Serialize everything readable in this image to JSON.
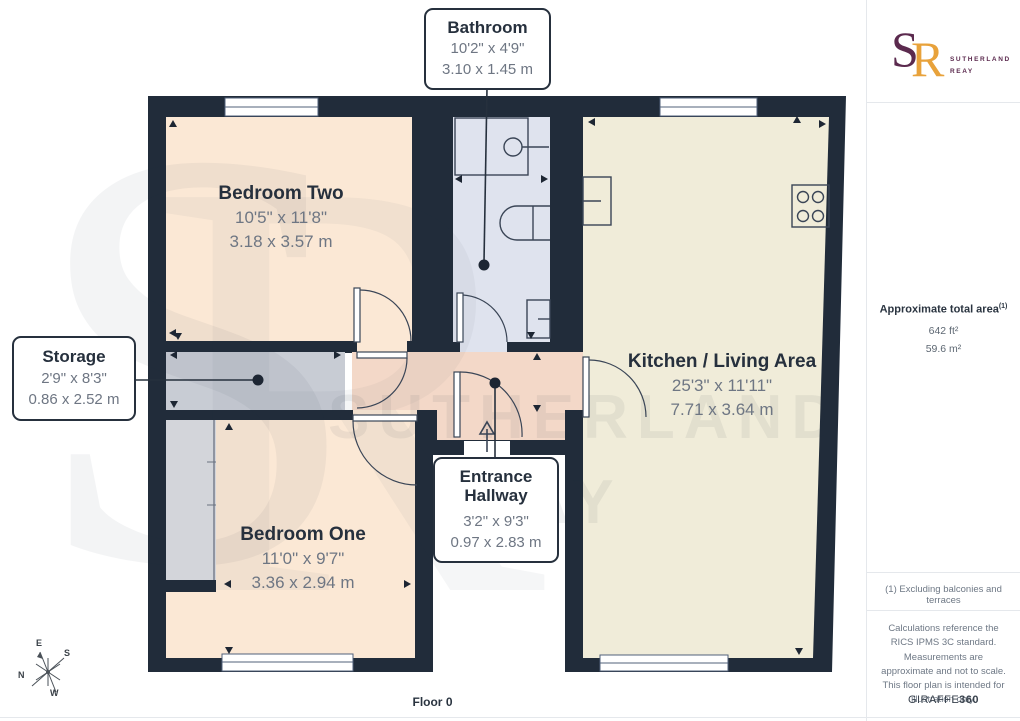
{
  "floorplan": {
    "floor_label": "Floor 0",
    "rooms": {
      "bathroom": {
        "name": "Bathroom",
        "imperial": "10'2\" x 4'9\"",
        "metric": "3.10 x 1.45 m"
      },
      "bedroom_two": {
        "name": "Bedroom Two",
        "imperial": "10'5\" x 11'8\"",
        "metric": "3.18 x 3.57 m"
      },
      "storage": {
        "name": "Storage",
        "imperial": "2'9\" x 8'3\"",
        "metric": "0.86 x 2.52 m"
      },
      "bedroom_one": {
        "name": "Bedroom One",
        "imperial": "11'0\" x 9'7\"",
        "metric": "3.36 x 2.94 m"
      },
      "kitchen_living": {
        "name": "Kitchen / Living Area",
        "imperial": "25'3\" x 11'11\"",
        "metric": "7.71 x 3.64 m"
      },
      "entrance_hallway": {
        "name_line1": "Entrance",
        "name_line2": "Hallway",
        "imperial": "3'2\" x 9'3\"",
        "metric": "0.97 x 2.83 m"
      }
    },
    "compass": {
      "n": "N",
      "e": "E",
      "s": "S",
      "w": "W"
    }
  },
  "watermark": {
    "monogram_s": "S",
    "monogram_r": "R",
    "line1": "SUTHERLAND",
    "line2": "REAY"
  },
  "sidebar": {
    "logo": {
      "monogram_s": "S",
      "monogram_r": "R",
      "name_line1": "SUTHERLAND",
      "name_line2": "REAY"
    },
    "area": {
      "title": "Approximate total area",
      "note_ref": "(1)",
      "imperial": "642 ft²",
      "metric": "59.6 m²"
    },
    "footnote": "(1) Excluding balconies and terraces",
    "disclaimer": "Calculations reference the RICS IPMS 3C standard. Measurements are approximate and not to scale. This floor plan is intended for illustration only.",
    "brand_name": "GIRAFFE",
    "brand_suffix": "360"
  },
  "colors": {
    "wall": "#212c3a",
    "bedroom_fill": "#fbe8d5",
    "kitchen_fill": "#f0ecd9",
    "bathroom_fill": "#dfe3ee",
    "hallway_fill": "#f3d8c8",
    "storage_fill": "#c8ccd4",
    "closet_fill": "#d3d5da",
    "logo_purple": "#5b2a4e",
    "logo_orange": "#e8a23b",
    "title_text": "#26303d",
    "dim_text": "#6e7683"
  }
}
